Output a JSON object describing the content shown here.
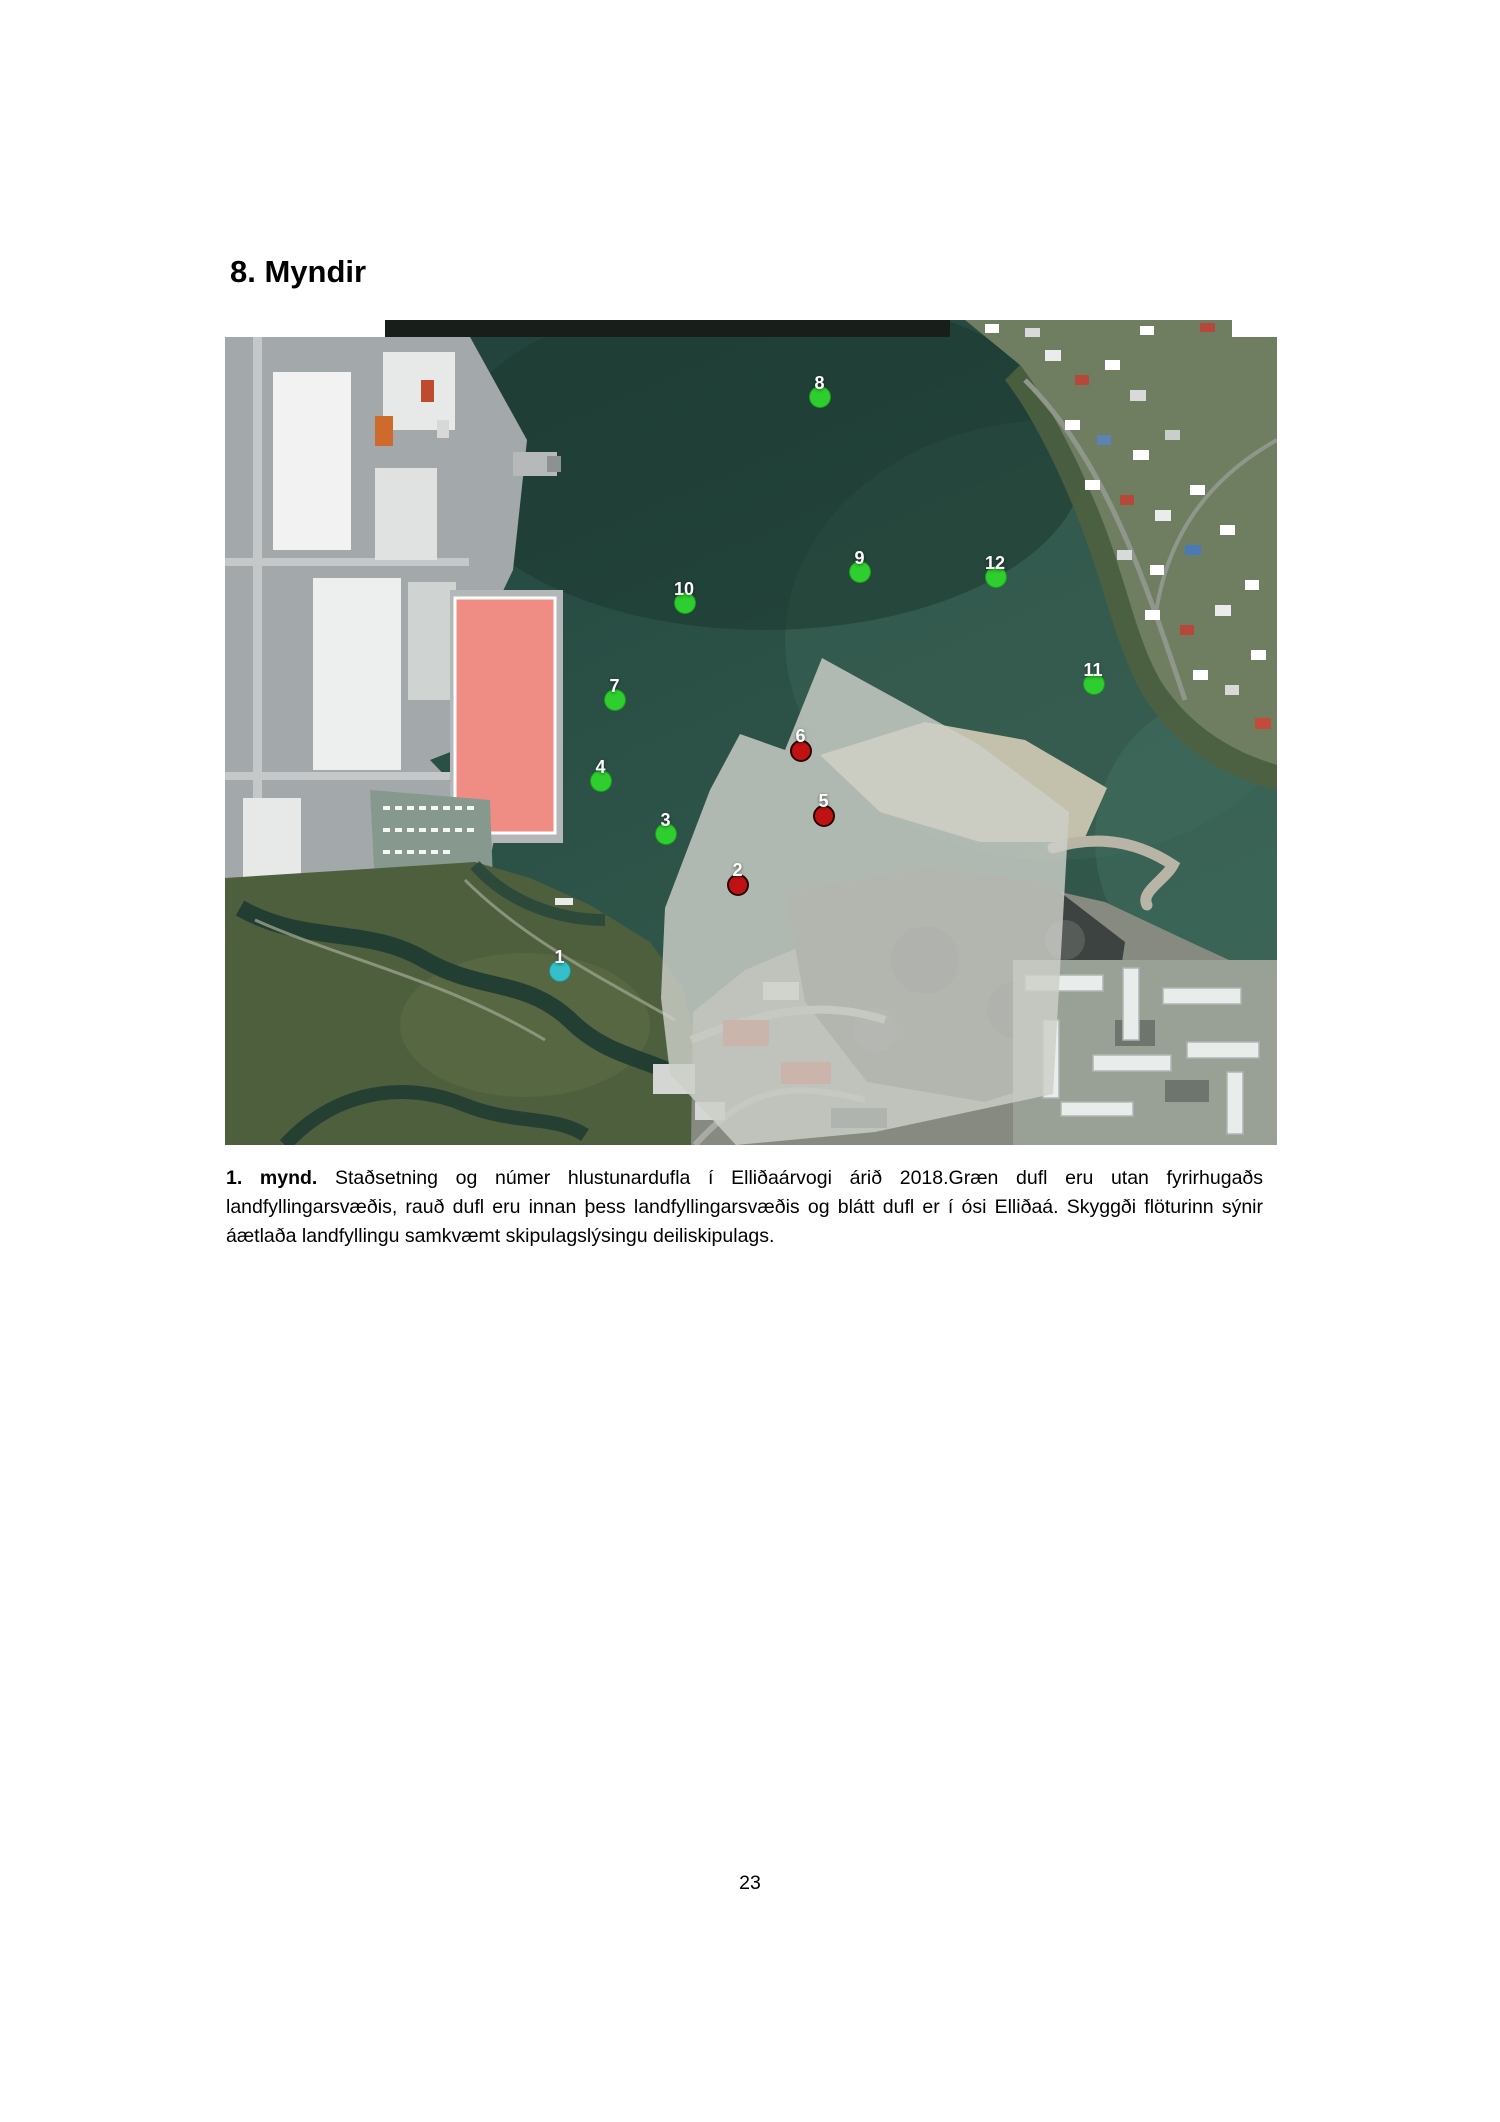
{
  "page": {
    "heading": "8. Myndir",
    "page_number": "23"
  },
  "figure": {
    "caption_label": "1. mynd.",
    "caption_text": " Staðsetning og númer hlustunardufla í Elliðaárvogi árið 2018.Græn dufl eru utan fyrirhugaðs landfyllingarsvæðis, rauð dufl eru innan þess landfyllingarsvæðis og blátt dufl er í ósi Elliðaá. Skyggði flöturinn sýnir áætlaða landfyllingu samkvæmt skipulagslýsingu deiliskipulags.",
    "legend_colors": {
      "green": "#2fce2f",
      "red": "#c01212",
      "blue": "#35c0c9"
    },
    "markers": [
      {
        "number": "1",
        "color": "blue",
        "x": 335,
        "y": 651
      },
      {
        "number": "2",
        "color": "red",
        "x": 513,
        "y": 565
      },
      {
        "number": "3",
        "color": "green",
        "x": 441,
        "y": 514
      },
      {
        "number": "4",
        "color": "green",
        "x": 376,
        "y": 461
      },
      {
        "number": "5",
        "color": "red",
        "x": 599,
        "y": 496
      },
      {
        "number": "6",
        "color": "red",
        "x": 576,
        "y": 431
      },
      {
        "number": "7",
        "color": "green",
        "x": 390,
        "y": 380
      },
      {
        "number": "8",
        "color": "green",
        "x": 595,
        "y": 77
      },
      {
        "number": "9",
        "color": "green",
        "x": 635,
        "y": 252
      },
      {
        "number": "10",
        "color": "green",
        "x": 460,
        "y": 283
      },
      {
        "number": "11",
        "color": "green",
        "x": 869,
        "y": 364
      },
      {
        "number": "12",
        "color": "green",
        "x": 771,
        "y": 257
      }
    ]
  }
}
